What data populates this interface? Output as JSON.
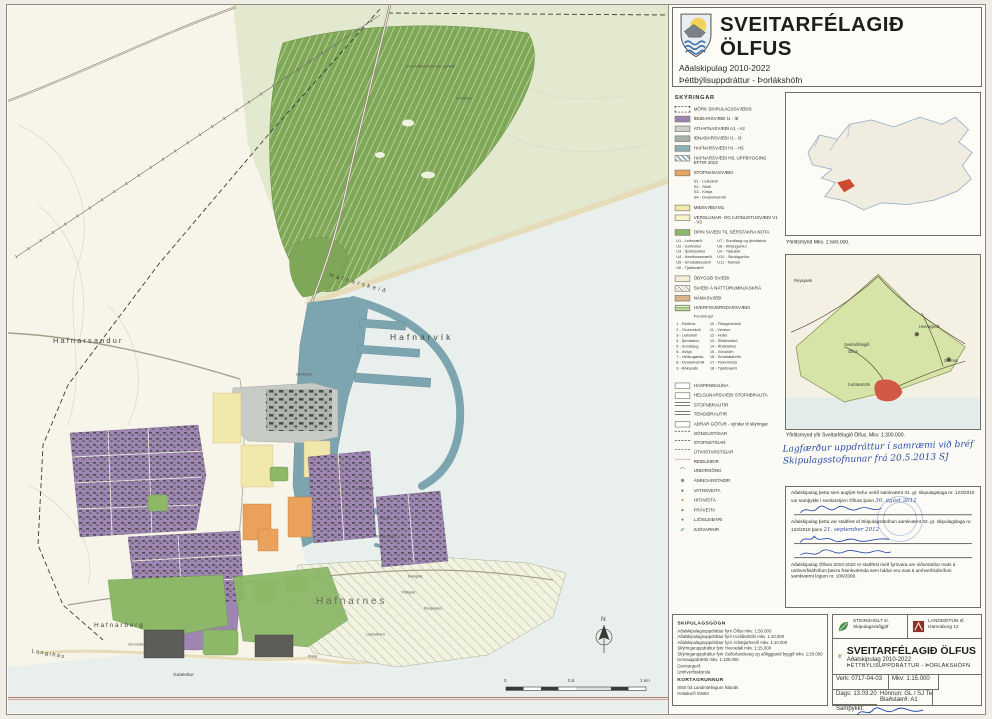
{
  "sheet": {
    "title": "SVEITARFÉLAGIÐ ÖLFUS",
    "subtitle1": "Aðalskipulag 2010-2022",
    "subtitle2": "Þéttbýlisuppdráttur - Þorlákshöfn"
  },
  "legend": {
    "title": "SKÝRINGAR",
    "areas1": [
      {
        "type": "sw-dashed",
        "label": "MÖRK SKIPULAGSSVÆÐIS"
      },
      {
        "type": "sw",
        "color": "#9b84ad",
        "label": "ÍBÚÐARSVÆÐI  Í1 - Í8"
      },
      {
        "type": "sw",
        "color": "#cbcfca",
        "label": "ATHAFNASVÆÐI  A1 - A2"
      },
      {
        "type": "sw",
        "color": "#aab1ac",
        "label": "IÐNAÐARSVÆÐI  I1 - I3"
      },
      {
        "type": "sw",
        "color": "#8eafb5",
        "label": "HAFNARSVÆÐI  H1 - H5"
      },
      {
        "type": "sw-hatchblue",
        "label": "HAFNARSVÆÐI H6, UPPBYGGING EFTIR 2022"
      },
      {
        "type": "sw",
        "color": "#eba55e",
        "label": "STOFNANASVÆÐI"
      }
    ],
    "stofnana_sub": [
      "S1 - Leikskóli",
      "S2 - Skóli",
      "S3 - Kirkja",
      "S4 - Dvalarheimili"
    ],
    "areas2": [
      {
        "type": "sw",
        "color": "#f2e9ae",
        "label": "MIÐSVÆÐI  M1"
      },
      {
        "type": "sw",
        "color": "#f7f2c8",
        "label": "VERSLUNAR- OG ÞJÓNUSTUSVÆÐI V1 - V3"
      },
      {
        "type": "sw",
        "color": "#8cb868",
        "label": "OPIN SVÆÐI TIL SÉRSTAKRA NOTA"
      }
    ],
    "open_col1": [
      "U1 - Leiksvæði",
      "U2 - Golfvöllur",
      "U3 - Íþróttavöllur",
      "U4 - Hesthúsasvæði",
      "U5 - Smábátasvæði",
      "U6 - Tjaldsvæði"
    ],
    "open_col2": [
      "U7 - Sundlaug og íþróttahús",
      "U8 - Kirkjugarður",
      "U9 - Trjárækt",
      "U10 - Skrúðgarður",
      "U11 - Náman"
    ],
    "areas3": [
      {
        "type": "sw",
        "color": "#f3efd6",
        "label": "ÓBYGGÐ SVÆÐI"
      },
      {
        "type": "sw-hatchdiag",
        "label": "SVÆÐI Á NÁTTÚRUMINJASKRÁ"
      },
      {
        "type": "sw",
        "color": "#ddb388",
        "label": "NÁMASVÆÐI"
      },
      {
        "type": "sw-greenstripes",
        "label": "HVERFISVERNDARSVÆÐI"
      }
    ],
    "hverfis_sub": [
      "Fornminjar"
    ],
    "num_col1": [
      "1 - Ráðhús",
      "2 - Grunnskóli",
      "3 - Leikskóli",
      "4 - Íþróttahús",
      "5 - Sundlaug",
      "6 - Kirkja",
      "7 - Heilsugæsla",
      "8 - Dvalarheimili",
      "9 - Bókasafn"
    ],
    "num_col2": [
      "10 - Félagsheimili",
      "11 - Verslun",
      "12 - Hótel",
      "13 - Slökkvistöð",
      "14 - Áhaldahús",
      "15 - Vöruhöfn",
      "16 - Smábátahöfn",
      "17 - Fiskvinnsla",
      "18 - Tjaldsvæði"
    ],
    "lines": [
      {
        "type": "sw-box",
        "label": "HÁSPENNULÍNA"
      },
      {
        "type": "sw-box",
        "label": "HELGUNARSVÆÐI STOFNBRAUTA"
      },
      {
        "type": "sw-road",
        "label": "STOFNBRAUTIR"
      },
      {
        "type": "sw-road",
        "label": "TENGIBRAUTIR"
      },
      {
        "type": "sw-box",
        "label": "AÐRAR GÖTUR - sýndar til skýringar"
      },
      {
        "type": "sw-dashline",
        "label": "GÖNGUSTÍGAR"
      },
      {
        "type": "sw-dashline",
        "label": "STOFNSTÍGAR"
      },
      {
        "type": "sw-dashline",
        "label": "ÚTIVISTARSTÍGAR"
      },
      {
        "type": "sw-dashdot",
        "label": "REIÐLEIÐIR"
      },
      {
        "type": "sw-sym c-dark",
        "glyph": "⌒",
        "label": "UNDIRGÖNG"
      },
      {
        "type": "sw-sym c-dark",
        "glyph": "⊕",
        "label": "ÁNINGARSTAÐIR"
      },
      {
        "type": "sw-sym c-blue",
        "glyph": "●",
        "label": "VATNSVEITA"
      },
      {
        "type": "sw-sym c-orange",
        "glyph": "●",
        "label": "HITAVEITA"
      },
      {
        "type": "sw-sym c-green",
        "glyph": "●",
        "label": "FRÁVEITA"
      },
      {
        "type": "sw-sym c-gray",
        "glyph": "●",
        "label": "LJÓSLEIÐARI"
      },
      {
        "type": "sw-sym c-blue",
        "glyph": "⁄⁄⁄",
        "label": "SJÓVARNIR"
      }
    ]
  },
  "overview": {
    "caption1": "Yfirlitsmynd Mkv. 1:500.000.",
    "caption2": "Yfirlitsmynd yfir Sveitarfélagið Ölfus. Mkv. 1:300.000.",
    "labels": {
      "reykjavik": "Reykjavík",
      "hveragerdi": "Hveragerði",
      "selfoss": "Selfoss",
      "olfus1": "Sveitarfélagið",
      "olfus2": "Ölfus",
      "thorlakshofn": "Þorlákshöfn"
    }
  },
  "note": {
    "handwritten": "Lagfærður uppdráttur í samræmi við bréf Skipulagsstofnunar frá 20.5.2013  SJ"
  },
  "approvals": {
    "a1_text": "Aðalskipulag þetta sem auglýst hefur verið samkvæmt 31. gr. skipulagslaga nr. 123/2010 var samþykkt í sveitarstjórn Ölfuss þann",
    "a1_hand": "30. ágúst 2012",
    "a2_text": "Aðalskipulag þetta var staðfest af Skipulagsstofnun samkvæmt 32. gr. skipulagslaga nr. 123/2010 þann",
    "a2_hand": "21. september 2012",
    "a3_text": "Aðalskipulag Ölfuss 2010-2022 er staðfest með fyrirvara um niðurstöður mats á umhverfisáhrifum þeirra framkvæmda sem háðar eru mati á umhverfisáhrifum samkvæmt lögum nr. 106/2000."
  },
  "gogn": {
    "title": "SKIPULAGSGÖGN",
    "lines": [
      "Aðalskipulagsuppdráttur fyrir Ölfus mkv. 1:50.000",
      "Aðalskipulagsuppdráttur fyrir Þorlákshöfn mkv. 1:10.000",
      "Aðalskipulagsuppdráttur fyrir Árbæjarhverfi mkv. 1:10.000",
      "Skýringaruppdráttur fyrir Hveradali mkv. 1:15.000",
      "Skýringaruppdráttur fyrir Suðurlandsveg og aðliggjandi byggð mkv. 1:20.000",
      "Þemauppdrættir mkv. 1:100.000",
      "Greinargerð",
      "Umhverfisskýrsla"
    ],
    "korta_title": "KORTAGRUNNUR",
    "korta_lines": [
      "IS50 frá Landmælingum Íslands",
      "Hnitakerfi ISN93"
    ]
  },
  "titleblock": {
    "firm1": "STEINSHOLT sf.",
    "firm1_sub": "Skipulagsráðgjöf",
    "firm2": "LANDMÓTUN sf.",
    "firm2_sub": "Hamraborg 12",
    "org": "SVEITARFÉLAGIÐ ÖLFUS",
    "plan": "Aðalskipulag 2010-2022",
    "sheetname": "ÞÉTTBÝLISUPPDRÁTTUR - ÞORLÁKSHÖFN",
    "verk": "Verk: 0717-04-03",
    "mkv": "Mkv: 1:15.000",
    "dags": "Dags: 13.03.2013",
    "blad": "Blaðstærð: A1",
    "honnun": "Hönnun: GL / SJ  Teiknað: GÓ",
    "samthykkt": "Samþykkt:"
  },
  "map": {
    "compass_n": "N",
    "scale": {
      "s0": "0",
      "s05": "0,5",
      "s1": "1 km"
    },
    "labels": [
      {
        "text": "H a f n a r s a n d u r",
        "x": "45px",
        "y": "332px",
        "cls": "t7"
      },
      {
        "text": "Hafnarvík",
        "x": "382px",
        "y": "328px",
        "cls": "t8 ls1"
      },
      {
        "text": "Hafnarskeið",
        "x": "322px",
        "y": "268px",
        "cls": "t6 ls1 rot16"
      },
      {
        "text": "Skötubót",
        "x": "288px",
        "y": "368px",
        "cls": "tt"
      },
      {
        "text": "Suðurvör",
        "x": "350px",
        "y": "482px",
        "cls": "tt"
      },
      {
        "text": "Ölver",
        "x": "372px",
        "y": "512px",
        "cls": "tt"
      },
      {
        "text": "Brekkuskjól",
        "x": "368px",
        "y": "530px",
        "cls": "tt"
      },
      {
        "text": "H a f n a r n e s",
        "x": "308px",
        "y": "592px",
        "cls": "t9"
      },
      {
        "text": "H a f n a r b e r g",
        "x": "86px",
        "y": "618px",
        "cls": "t6"
      },
      {
        "text": "L a n g i b á s",
        "x": "24px",
        "y": "644px",
        "cls": "t6 rot10"
      },
      {
        "text": "Gatklettur",
        "x": "165px",
        "y": "668px",
        "cls": "t5"
      },
      {
        "text": "Grunnabás",
        "x": "120px",
        "y": "638px",
        "cls": "tt"
      },
      {
        "text": "Renglás",
        "x": "400px",
        "y": "570px",
        "cls": "tt"
      },
      {
        "text": "Ýtribyrki",
        "x": "393px",
        "y": "586px",
        "cls": "tt"
      },
      {
        "text": "Flesjasker",
        "x": "416px",
        "y": "602px",
        "cls": "tt"
      },
      {
        "text": "Leiðarhorn",
        "x": "358px",
        "y": "628px",
        "cls": "tt"
      },
      {
        "text": "Flásir",
        "x": "300px",
        "y": "650px",
        "cls": "tt"
      },
      {
        "text": "Framtíðarsvæði fyrir golfvöll",
        "x": "398px",
        "y": "60px",
        "cls": "tt"
      },
      {
        "text": "Friðmörk",
        "x": "448px",
        "y": "92px",
        "cls": "tt"
      }
    ]
  }
}
